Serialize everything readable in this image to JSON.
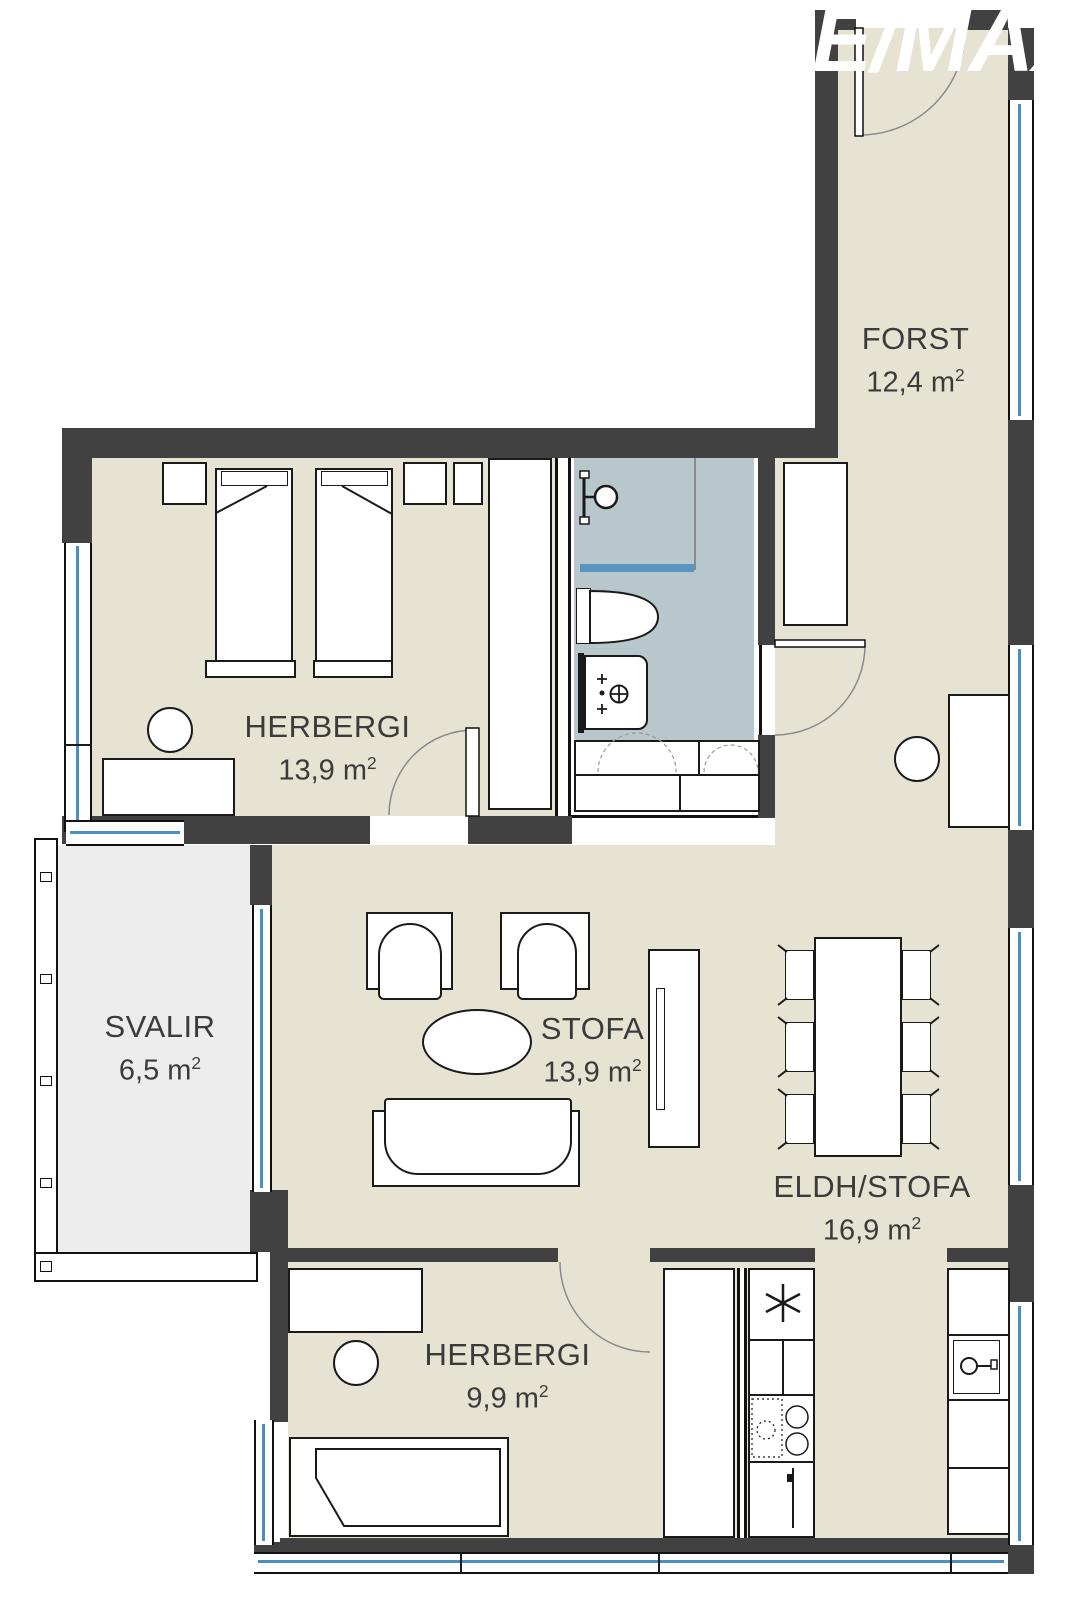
{
  "watermark": {
    "text": "E/MAX"
  },
  "rooms": [
    {
      "id": "forst",
      "label": "FORST",
      "area_text": "12,4 m",
      "sup": "2"
    },
    {
      "id": "herbergi-1",
      "label": "HERBERGI",
      "area_text": "13,9 m",
      "sup": "2"
    },
    {
      "id": "svalir",
      "label": "SVALIR",
      "area_text": "6,5 m",
      "sup": "2"
    },
    {
      "id": "stofa",
      "label": "STOFA",
      "area_text": "13,9 m",
      "sup": "2"
    },
    {
      "id": "eldh-stofa",
      "label": "ELDH/STOFA",
      "area_text": "16,9 m",
      "sup": "2"
    },
    {
      "id": "herbergi-2",
      "label": "HERBERGI",
      "area_text": "9,9 m",
      "sup": "2"
    }
  ],
  "colors": {
    "wall": "#414141",
    "floor": "#e7e3d3",
    "bathroom_floor": "#b7c7cc",
    "balcony_floor": "#ededed",
    "window_glass": "#4a8fc0",
    "furniture_outline": "#1a1a1a",
    "label_text": "#3b3b3b",
    "watermark": "#ffffff"
  }
}
